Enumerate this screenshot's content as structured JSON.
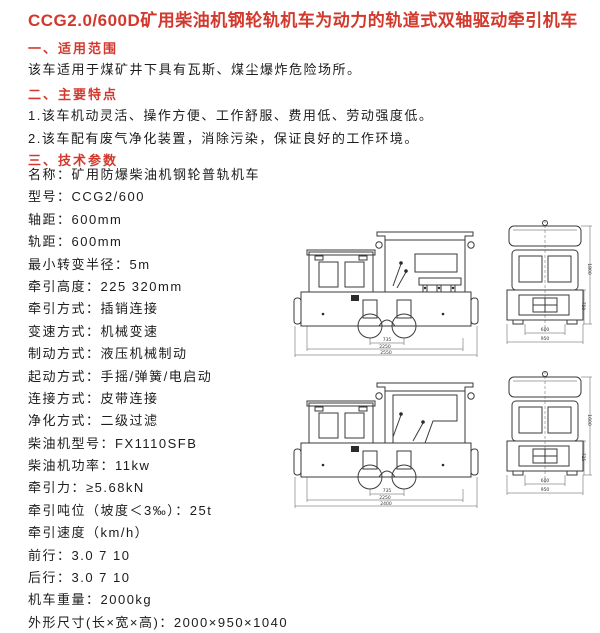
{
  "page_title": "CCG2.0/600D矿用柴油机钢轮轨机车为动力的轨道式双轴驱动牵引机车",
  "colors": {
    "accent_red": "#d2382c",
    "text": "#1c1c1c",
    "drawing_line": "#3a3a3a"
  },
  "sections": {
    "scope": {
      "heading": "一、适用范围",
      "body": "该车适用于煤矿井下具有瓦斯、煤尘爆炸危险场所。"
    },
    "features": {
      "heading": "二、主要特点",
      "items": [
        "1.该车机动灵活、操作方便、工作舒服、费用低、劳动强度低。",
        "2.该车配有废气净化装置，消除污染，保证良好的工作环境。"
      ]
    },
    "parameters": {
      "heading": "三、技术参数"
    }
  },
  "specs": {
    "lines": [
      "名称：矿用防爆柴油机钢轮普轨机车",
      "型号：CCG2/600",
      "轴距：600mm",
      "轨距：600mm",
      "最小转变半径：5m",
      "牵引高度：225 320mm",
      "牵引方式：插销连接",
      "变速方式：机械变速",
      "制动方式：液压机械制动",
      "起动方式：手摇/弹簧/电启动",
      "连接方式：皮带连接",
      "净化方式：二级过滤",
      "柴油机型号：FX1110SFB",
      "柴油机功率：11kw",
      "牵引力：≥5.68kN",
      "牵引吨位（坡度＜3‰）：25t",
      "牵引速度（km/h）",
      "前行：3.0  7  10",
      "后行：3.0  7  10",
      "机车重量：2000kg",
      "外形尺寸(长×宽×高)：2000×950×1040"
    ]
  },
  "drawings": {
    "top": {
      "side_dims": [
        "735",
        "2250",
        "2550"
      ],
      "front_dims": [
        "600",
        "950"
      ],
      "front_vdims": [
        "1800",
        "750"
      ]
    },
    "bottom": {
      "side_dims": [
        "735",
        "2250",
        "2400"
      ],
      "front_dims": [
        "600",
        "950"
      ],
      "front_vdims": [
        "1600",
        "725"
      ]
    }
  }
}
